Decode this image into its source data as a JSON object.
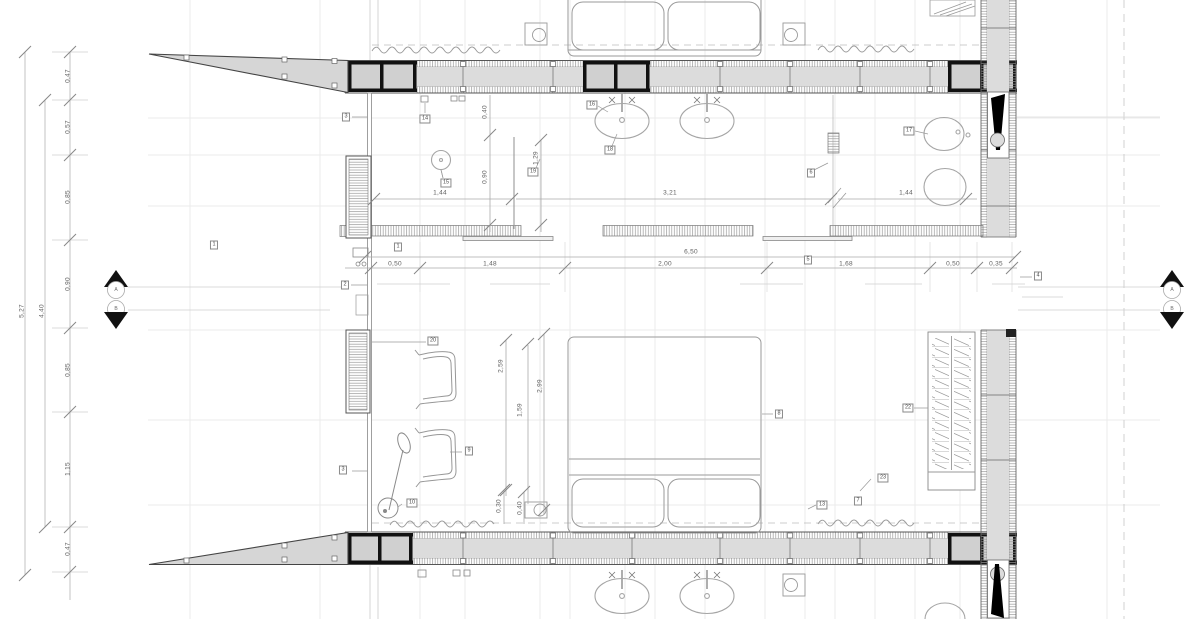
{
  "drawing_type": "architectural-floor-plan",
  "colors": {
    "wall_fill": "#dcdcdc",
    "hatch": "#9a9a9a",
    "line": "#8a8a8a",
    "beam": "#111111"
  },
  "section_markers": {
    "left_top": "A",
    "left_bottom": "B",
    "right_top": "A",
    "right_bottom": "B"
  },
  "dims": {
    "left_chain": [
      "0,47",
      "0,57",
      "0,85",
      "0,90",
      "0,85",
      "1,15",
      "0,47"
    ],
    "left_totals": [
      "5,27",
      "4,40"
    ],
    "center_chain": [
      "0,50",
      "1,48",
      "2,00",
      "1,68",
      "0,50",
      "0,35"
    ],
    "center_total": "6,50",
    "bath_row": [
      "1,44",
      "3,21",
      "1,44"
    ],
    "bath_vertical": [
      "0,40",
      "0,90",
      "1,29"
    ],
    "bedroom_vertical": [
      "2,59",
      "2,99",
      "1,59",
      "0,30",
      "0,40"
    ]
  },
  "keynotes": [
    {
      "label": "3"
    },
    {
      "label": "14"
    },
    {
      "label": "15"
    },
    {
      "label": "19"
    },
    {
      "label": "16"
    },
    {
      "label": "18"
    },
    {
      "label": "6"
    },
    {
      "label": "17"
    },
    {
      "label": "1"
    },
    {
      "label": "1"
    },
    {
      "label": "2"
    },
    {
      "label": "5"
    },
    {
      "label": "4"
    },
    {
      "label": "20"
    },
    {
      "label": "9"
    },
    {
      "label": "3"
    },
    {
      "label": "10"
    },
    {
      "label": "8"
    },
    {
      "label": "22"
    },
    {
      "label": "23"
    },
    {
      "label": "13"
    },
    {
      "label": "7"
    }
  ]
}
